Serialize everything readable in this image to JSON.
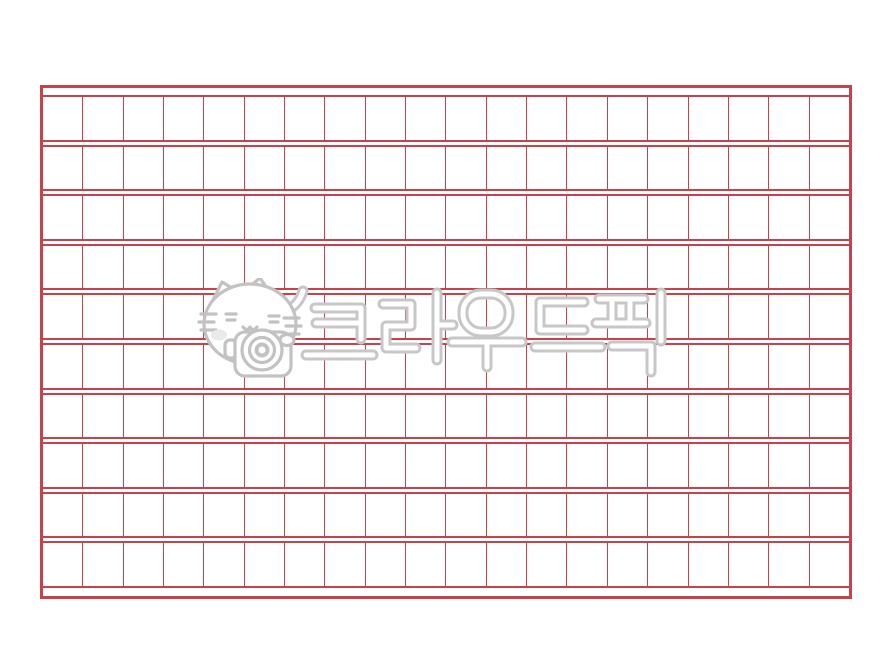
{
  "page": {
    "paper_color": "#ffffff"
  },
  "grid": {
    "rows": 10,
    "columns": 20,
    "total_cells": 200,
    "line_color": "#c8414b"
  },
  "watermark": {
    "text": "크라우드픽",
    "mascot": "cat-holding-camera",
    "outline_color": "#c7c7c7",
    "tube_fill_color": "#ffffff"
  }
}
